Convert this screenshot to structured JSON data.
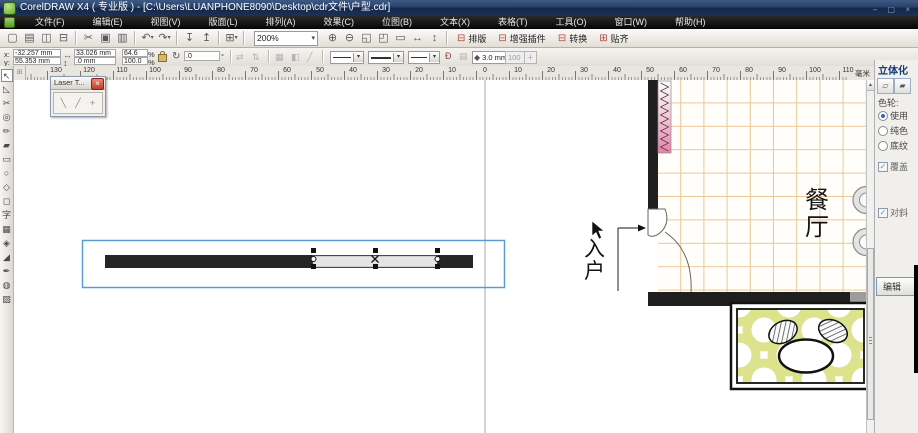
{
  "window": {
    "title": "CorelDRAW X4 ( 专业版 ) - [C:\\Users\\LUANPHONE8090\\Desktop\\cdr文件\\户型.cdr]"
  },
  "menu": {
    "items": [
      "文件(F)",
      "编辑(E)",
      "视图(V)",
      "版面(L)",
      "排列(A)",
      "效果(C)",
      "位图(B)",
      "文本(X)",
      "表格(T)",
      "工具(O)",
      "窗口(W)",
      "帮助(H)"
    ]
  },
  "toolbar": {
    "zoom_value": "200%",
    "icons_left": [
      {
        "name": "new-icon",
        "g": "▢"
      },
      {
        "name": "open-icon",
        "g": "▤"
      },
      {
        "name": "save-icon",
        "g": "◫"
      },
      {
        "name": "print-icon",
        "g": "⊟"
      },
      {
        "sep": true
      },
      {
        "name": "cut-icon",
        "g": "✂"
      },
      {
        "name": "copy-icon",
        "g": "▣"
      },
      {
        "name": "paste-icon",
        "g": "▥"
      },
      {
        "sep": true
      },
      {
        "name": "undo-icon",
        "g": "↶",
        "drop": true
      },
      {
        "name": "redo-icon",
        "g": "↷",
        "drop": true
      },
      {
        "sep": true
      },
      {
        "name": "import-icon",
        "g": "↧"
      },
      {
        "name": "export-icon",
        "g": "↥"
      },
      {
        "sep": true
      },
      {
        "name": "app-launcher-icon",
        "g": "⊞",
        "drop": true
      },
      {
        "sep": true
      }
    ],
    "icons_right": [
      {
        "name": "zoom-in-icon",
        "g": "⊕"
      },
      {
        "name": "zoom-out-icon",
        "g": "⊖"
      },
      {
        "name": "zoom-selected-icon",
        "g": "◱"
      },
      {
        "name": "zoom-all-icon",
        "g": "◰"
      },
      {
        "name": "zoom-page-icon",
        "g": "▭"
      },
      {
        "name": "zoom-width-icon",
        "g": "↔"
      },
      {
        "name": "zoom-height-icon",
        "g": "↕"
      }
    ],
    "plugin_buttons": [
      {
        "icon": "⊟",
        "label": "排版"
      },
      {
        "icon": "⊟",
        "label": "增强插件"
      },
      {
        "icon": "⊟",
        "label": "转换"
      },
      {
        "icon": "⊞",
        "label": "贴齐"
      }
    ]
  },
  "property_bar": {
    "x_label": "x:",
    "x_value": "-32.257 mm",
    "y_label": "y:",
    "y_value": "55.353 mm",
    "width_value": "33.026 mm",
    "height_value": ".0 mm",
    "scale_h": "64.6",
    "scale_v": "100.0",
    "percent_sign": "%",
    "angle_value": ".0",
    "degree_sign": "°",
    "outline_width": "3.0 mm",
    "spin_value": "100",
    "spin_plus": "＋"
  },
  "ruler": {
    "labels": [
      "130",
      "120",
      "110",
      "100",
      "90",
      "80",
      "70",
      "60",
      "50",
      "40",
      "30",
      "20",
      "10",
      "0",
      "10",
      "20",
      "30",
      "40",
      "50",
      "60",
      "70",
      "80",
      "90",
      "100",
      "110"
    ],
    "unit": "毫米"
  },
  "toolbox": {
    "tools": [
      {
        "name": "pick-tool-icon",
        "glyph": "↖",
        "selected": true
      },
      {
        "name": "shape-tool-icon",
        "glyph": "◺"
      },
      {
        "name": "crop-tool-icon",
        "glyph": "✂"
      },
      {
        "name": "zoom-tool-icon",
        "glyph": "◎"
      },
      {
        "name": "freehand-tool-icon",
        "glyph": "✏"
      },
      {
        "name": "smart-fill-tool-icon",
        "glyph": "▰"
      },
      {
        "name": "rectangle-tool-icon",
        "glyph": "▭"
      },
      {
        "name": "ellipse-tool-icon",
        "glyph": "○"
      },
      {
        "name": "polygon-tool-icon",
        "glyph": "◇"
      },
      {
        "name": "basic-shapes-tool-icon",
        "glyph": "◻"
      },
      {
        "name": "text-tool-icon",
        "glyph": "字"
      },
      {
        "name": "table-tool-icon",
        "glyph": "▦"
      },
      {
        "name": "interactive-blend-tool-icon",
        "glyph": "◈"
      },
      {
        "name": "eyedropper-tool-icon",
        "glyph": "◢"
      },
      {
        "name": "outline-pen-tool-icon",
        "glyph": "✒"
      },
      {
        "name": "fill-tool-icon",
        "glyph": "◍"
      },
      {
        "name": "interactive-fill-tool-icon",
        "glyph": "▨"
      }
    ]
  },
  "laser_window": {
    "title": "Laser T...",
    "close": "×",
    "buttons": [
      {
        "name": "laser-path-1-icon",
        "g": "╲"
      },
      {
        "name": "laser-path-2-icon",
        "g": "╱"
      },
      {
        "name": "laser-wrench-icon",
        "g": "+"
      }
    ]
  },
  "canvas": {
    "entry_label": "入户",
    "dining_label": "餐厅"
  },
  "docker": {
    "title": "立体化",
    "color_wheel_label": "色轮:",
    "radios": [
      {
        "label": "使用",
        "selected": true
      },
      {
        "label": "纯色",
        "selected": false
      },
      {
        "label": "底纹",
        "selected": false
      }
    ],
    "checkboxes": [
      {
        "label": "覆盖",
        "checked": true
      },
      {
        "label": "对斜",
        "checked": true
      }
    ],
    "edit_button": "编辑",
    "check_glyph": "✓"
  },
  "scrollbar": {
    "up_glyph": "▲"
  },
  "colors": {
    "selection_blue": "#5b9bd0",
    "wall_black": "#1f1f1f",
    "tile_line_orange": "#eac795",
    "radiator_pink": "#ec7fa9",
    "ring_yellow": "#dde28c"
  }
}
